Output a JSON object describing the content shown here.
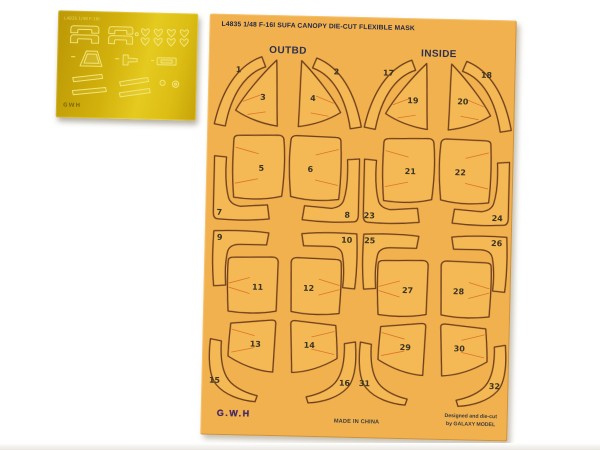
{
  "pe_sheet": {
    "code_text": "L4835 1/48 F-16I",
    "logo_text": "GWH",
    "base_color": "#d2b00c",
    "etch_color": "#f1e476"
  },
  "mask_sheet": {
    "title": "L4835 1/48 F-16I SUFA CANOPY DIE-CUT FLEXIBLE MASK",
    "left_section_label": "OUTBD",
    "right_section_label": "INSIDE",
    "logo_text": "G.W.H",
    "made_in_text": "MADE IN CHINA",
    "designer_line1": "Designed and die-cut",
    "designer_line2": "by GALAXY MODEL",
    "colors": {
      "sheet": "#f0b14e",
      "part_fill": "#f4b954",
      "outline": "#6e3d1c",
      "crease": "#dd7126",
      "number": "#3c3422",
      "title_text": "#242848",
      "logo_text": "#46276b"
    },
    "parts": [
      {
        "num": "1",
        "kind": "curved-band",
        "type": "arc",
        "x": 7,
        "y": 42,
        "flip": false,
        "nx": 30,
        "ny": 58
      },
      {
        "num": "2",
        "kind": "curved-band",
        "type": "arc",
        "x": 104,
        "y": 42,
        "flip": true,
        "nx": 128,
        "ny": 58
      },
      {
        "num": "3",
        "kind": "canopy-triangle",
        "type": "tri",
        "x": 28,
        "y": 45,
        "flip": false,
        "nx": 55,
        "ny": 85
      },
      {
        "num": "4",
        "kind": "canopy-triangle",
        "type": "tri",
        "x": 89,
        "y": 45,
        "flip": true,
        "nx": 105,
        "ny": 85
      },
      {
        "num": "5",
        "kind": "main-panel",
        "type": "sqA",
        "x": 24,
        "y": 119,
        "flip": false,
        "nx": 55,
        "ny": 156
      },
      {
        "num": "6",
        "kind": "main-panel",
        "type": "sqA",
        "x": 82,
        "y": 119,
        "flip": true,
        "nx": 104,
        "ny": 156
      },
      {
        "num": "7",
        "kind": "corner-strip",
        "type": "Lbl",
        "x": 7,
        "y": 142,
        "flip": false,
        "nx": 14,
        "ny": 201
      },
      {
        "num": "8",
        "kind": "corner-strip",
        "type": "Lbl",
        "x": 97,
        "y": 142,
        "flip": true,
        "nx": 142,
        "ny": 201
      },
      {
        "num": "9",
        "kind": "corner-strip",
        "type": "Ltl",
        "x": 8,
        "y": 216,
        "flip": false,
        "nx": 15,
        "ny": 226
      },
      {
        "num": "10",
        "kind": "corner-strip",
        "type": "Ltl",
        "x": 95,
        "y": 216,
        "flip": true,
        "nx": 142,
        "ny": 226
      },
      {
        "num": "11",
        "kind": "main-panel",
        "type": "sqB",
        "x": 22,
        "y": 241,
        "flip": false,
        "nx": 54,
        "ny": 275
      },
      {
        "num": "12",
        "kind": "main-panel",
        "type": "sqB",
        "x": 86,
        "y": 241,
        "flip": true,
        "nx": 105,
        "ny": 275
      },
      {
        "num": "13",
        "kind": "rear-panel",
        "type": "trapA",
        "x": 25,
        "y": 305,
        "flip": false,
        "nx": 53,
        "ny": 332
      },
      {
        "num": "14",
        "kind": "rear-panel",
        "type": "trapA",
        "x": 87,
        "y": 305,
        "flip": true,
        "nx": 107,
        "ny": 332
      },
      {
        "num": "15",
        "kind": "curved-strip",
        "type": "curveBL",
        "x": 6,
        "y": 325,
        "flip": false,
        "nx": 13,
        "ny": 369
      },
      {
        "num": "16",
        "kind": "curved-strip",
        "type": "curveBL",
        "x": 105,
        "y": 325,
        "flip": true,
        "nx": 143,
        "ny": 369
      },
      {
        "num": "17",
        "kind": "curved-band",
        "type": "arc",
        "x": 157,
        "y": 42,
        "flip": false,
        "nx": 180,
        "ny": 58
      },
      {
        "num": "18",
        "kind": "curved-band",
        "type": "arc",
        "x": 254,
        "y": 42,
        "flip": true,
        "nx": 278,
        "ny": 58
      },
      {
        "num": "19",
        "kind": "canopy-triangle",
        "type": "tri",
        "x": 178,
        "y": 45,
        "flip": false,
        "nx": 205,
        "ny": 85
      },
      {
        "num": "20",
        "kind": "canopy-triangle",
        "type": "tri",
        "x": 239,
        "y": 45,
        "flip": true,
        "nx": 255,
        "ny": 85
      },
      {
        "num": "21",
        "kind": "main-panel",
        "type": "sqA",
        "x": 174,
        "y": 119,
        "flip": false,
        "nx": 204,
        "ny": 156
      },
      {
        "num": "22",
        "kind": "main-panel",
        "type": "sqA",
        "x": 232,
        "y": 119,
        "flip": true,
        "nx": 254,
        "ny": 156
      },
      {
        "num": "23",
        "kind": "corner-strip",
        "type": "Lbl",
        "x": 157,
        "y": 142,
        "flip": false,
        "nx": 164,
        "ny": 201
      },
      {
        "num": "24",
        "kind": "corner-strip",
        "type": "Lbl",
        "x": 247,
        "y": 142,
        "flip": true,
        "nx": 292,
        "ny": 201
      },
      {
        "num": "25",
        "kind": "corner-strip",
        "type": "Ltl",
        "x": 158,
        "y": 216,
        "flip": false,
        "nx": 165,
        "ny": 226
      },
      {
        "num": "26",
        "kind": "corner-strip",
        "type": "Ltl",
        "x": 245,
        "y": 216,
        "flip": true,
        "nx": 292,
        "ny": 226
      },
      {
        "num": "27",
        "kind": "main-panel",
        "type": "sqB",
        "x": 172,
        "y": 241,
        "flip": false,
        "nx": 204,
        "ny": 275
      },
      {
        "num": "28",
        "kind": "main-panel",
        "type": "sqB",
        "x": 236,
        "y": 241,
        "flip": true,
        "nx": 255,
        "ny": 275
      },
      {
        "num": "29",
        "kind": "rear-panel",
        "type": "trapA",
        "x": 175,
        "y": 305,
        "flip": false,
        "nx": 203,
        "ny": 332
      },
      {
        "num": "30",
        "kind": "rear-panel",
        "type": "trapA",
        "x": 237,
        "y": 305,
        "flip": true,
        "nx": 257,
        "ny": 332
      },
      {
        "num": "31",
        "kind": "curved-strip",
        "type": "curveBL",
        "x": 156,
        "y": 325,
        "flip": false,
        "nx": 163,
        "ny": 369
      },
      {
        "num": "32",
        "kind": "curved-strip",
        "type": "curveBL",
        "x": 255,
        "y": 325,
        "flip": true,
        "nx": 293,
        "ny": 369
      }
    ]
  }
}
